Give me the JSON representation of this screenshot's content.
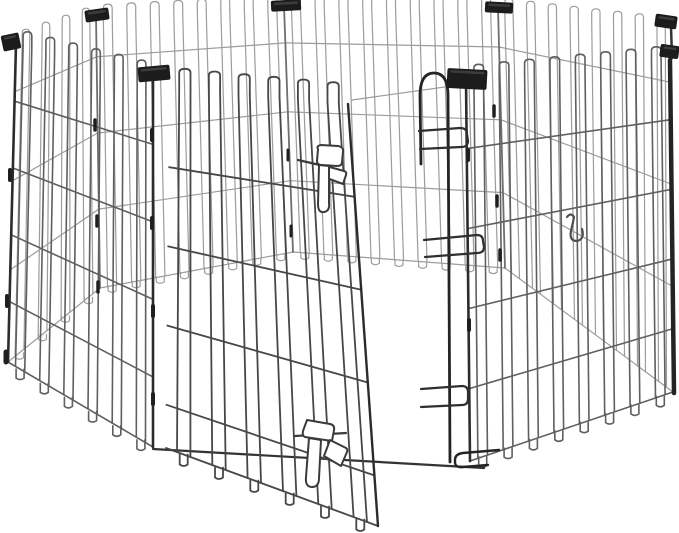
{
  "image": {
    "kind": "product-photo",
    "subject": "Black foldable metal wire pet exercise playpen with arched-top panels, black corner clips, and an open flip-latch door, on a white background",
    "background": "#ffffff"
  },
  "colors": {
    "background": "#ffffff",
    "wire_far": "#9c9c9c",
    "wire_far_post": "#6e6e6e",
    "wire_front": "#5f5f5f",
    "wire_door": "#474747",
    "post": "#2c2c2c",
    "heavy": "#242424",
    "clip": "#1c1c1c",
    "clip_highlight": "#4f4f4f",
    "latch_stroke": "#3b3b3b",
    "latch_fill": "#ffffff",
    "hook": "#4f4f4f",
    "front_bottom_rail": "#333333"
  },
  "parts": {
    "door_state": "open",
    "visible_panel_count": 7,
    "corner_clip_count": 7,
    "door_latch_count": 2,
    "ground_hook_count": 1
  }
}
